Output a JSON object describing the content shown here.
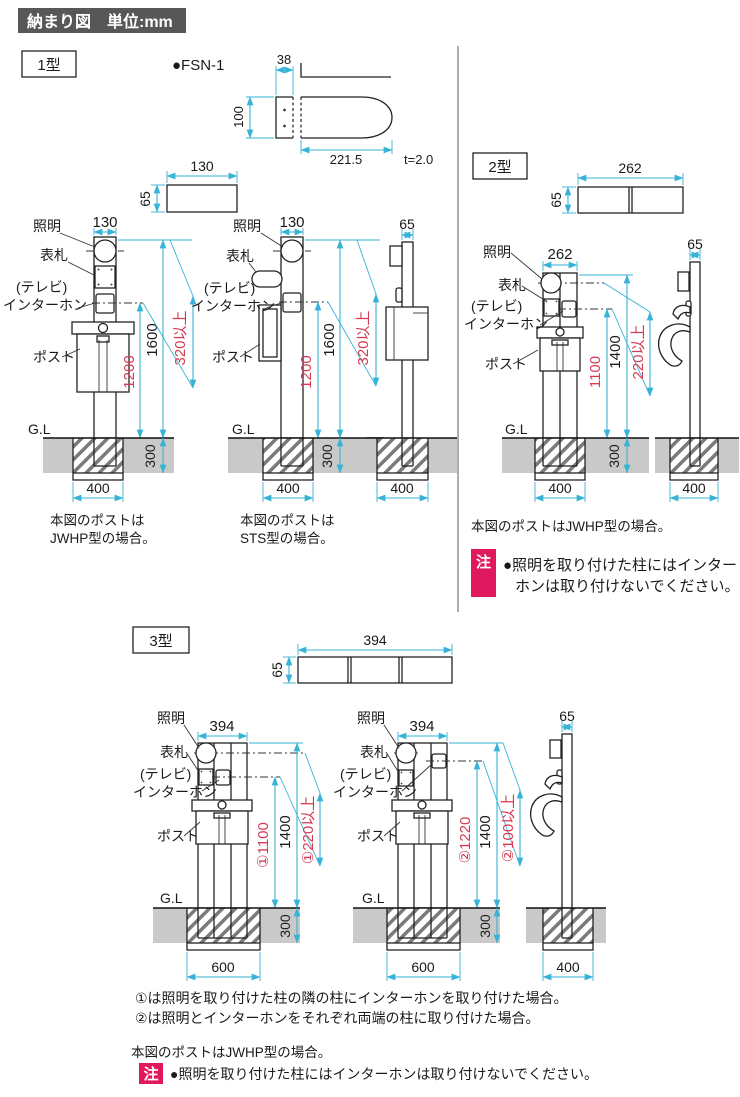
{
  "header": {
    "title": "納まり図　単位:mm"
  },
  "labels": {
    "light": "照明",
    "nameplate": "表札",
    "tv": "(テレビ)",
    "intercom": "インターホン",
    "post": "ポスト",
    "ground": "G.L"
  },
  "colors": {
    "dimension_cyan": "#36b3d6",
    "dimension_red": "#d63a52",
    "note_pink": "#e0195f",
    "header_gray": "#575757",
    "ground_gray": "#c9c9c9"
  },
  "type1": {
    "name": "1型",
    "product": "●FSN-1",
    "bracket": {
      "w": "38",
      "h": "100",
      "len": "221.5",
      "thick": "t=2.0"
    },
    "plan": {
      "w": "130",
      "h": "65"
    },
    "front_jwhp": {
      "width": "130",
      "mid": "1200",
      "total": "1600",
      "min": "320以上",
      "embed": "300",
      "footing": "400",
      "cap1": "本図のポストは",
      "cap2": "JWHP型の場合。"
    },
    "front_sts": {
      "width": "130",
      "mid": "1200",
      "total": "1600",
      "min": "320以上",
      "embed": "300",
      "footing": "400",
      "cap1": "本図のポストは",
      "cap2": "STS型の場合。"
    },
    "side": {
      "width": "65",
      "footing": "400"
    }
  },
  "type2": {
    "name": "2型",
    "plan": {
      "w": "262",
      "h": "65"
    },
    "front": {
      "width": "262",
      "mid": "1100",
      "total": "1400",
      "min": "220以上",
      "embed": "300",
      "footing": "400"
    },
    "side": {
      "width": "65",
      "footing": "400"
    },
    "caption": "本図のポストはJWHP型の場合。",
    "note": {
      "tag": "注",
      "line1": "●照明を取り付けた柱にはインター",
      "line2": "ホンは取り付けないでください。"
    }
  },
  "type3": {
    "name": "3型",
    "plan": {
      "w": "394",
      "h": "65"
    },
    "front1": {
      "width": "394",
      "mid": "①1100",
      "total": "1400",
      "min": "①220以上",
      "embed": "300",
      "footing": "600"
    },
    "front2": {
      "width": "394",
      "mid": "②1220",
      "total": "1400",
      "min": "②100以上",
      "embed": "300",
      "footing": "600"
    },
    "side": {
      "width": "65",
      "footing": "400"
    },
    "note1": "①は照明を取り付けた柱の隣の柱にインターホンを取り付けた場合。",
    "note2": "②は照明とインターホンをそれぞれ両端の柱に取り付けた場合。",
    "caption": "本図のポストはJWHP型の場合。",
    "note": {
      "tag": "注",
      "text": "●照明を取り付けた柱にはインターホンは取り付けないでください。"
    }
  }
}
